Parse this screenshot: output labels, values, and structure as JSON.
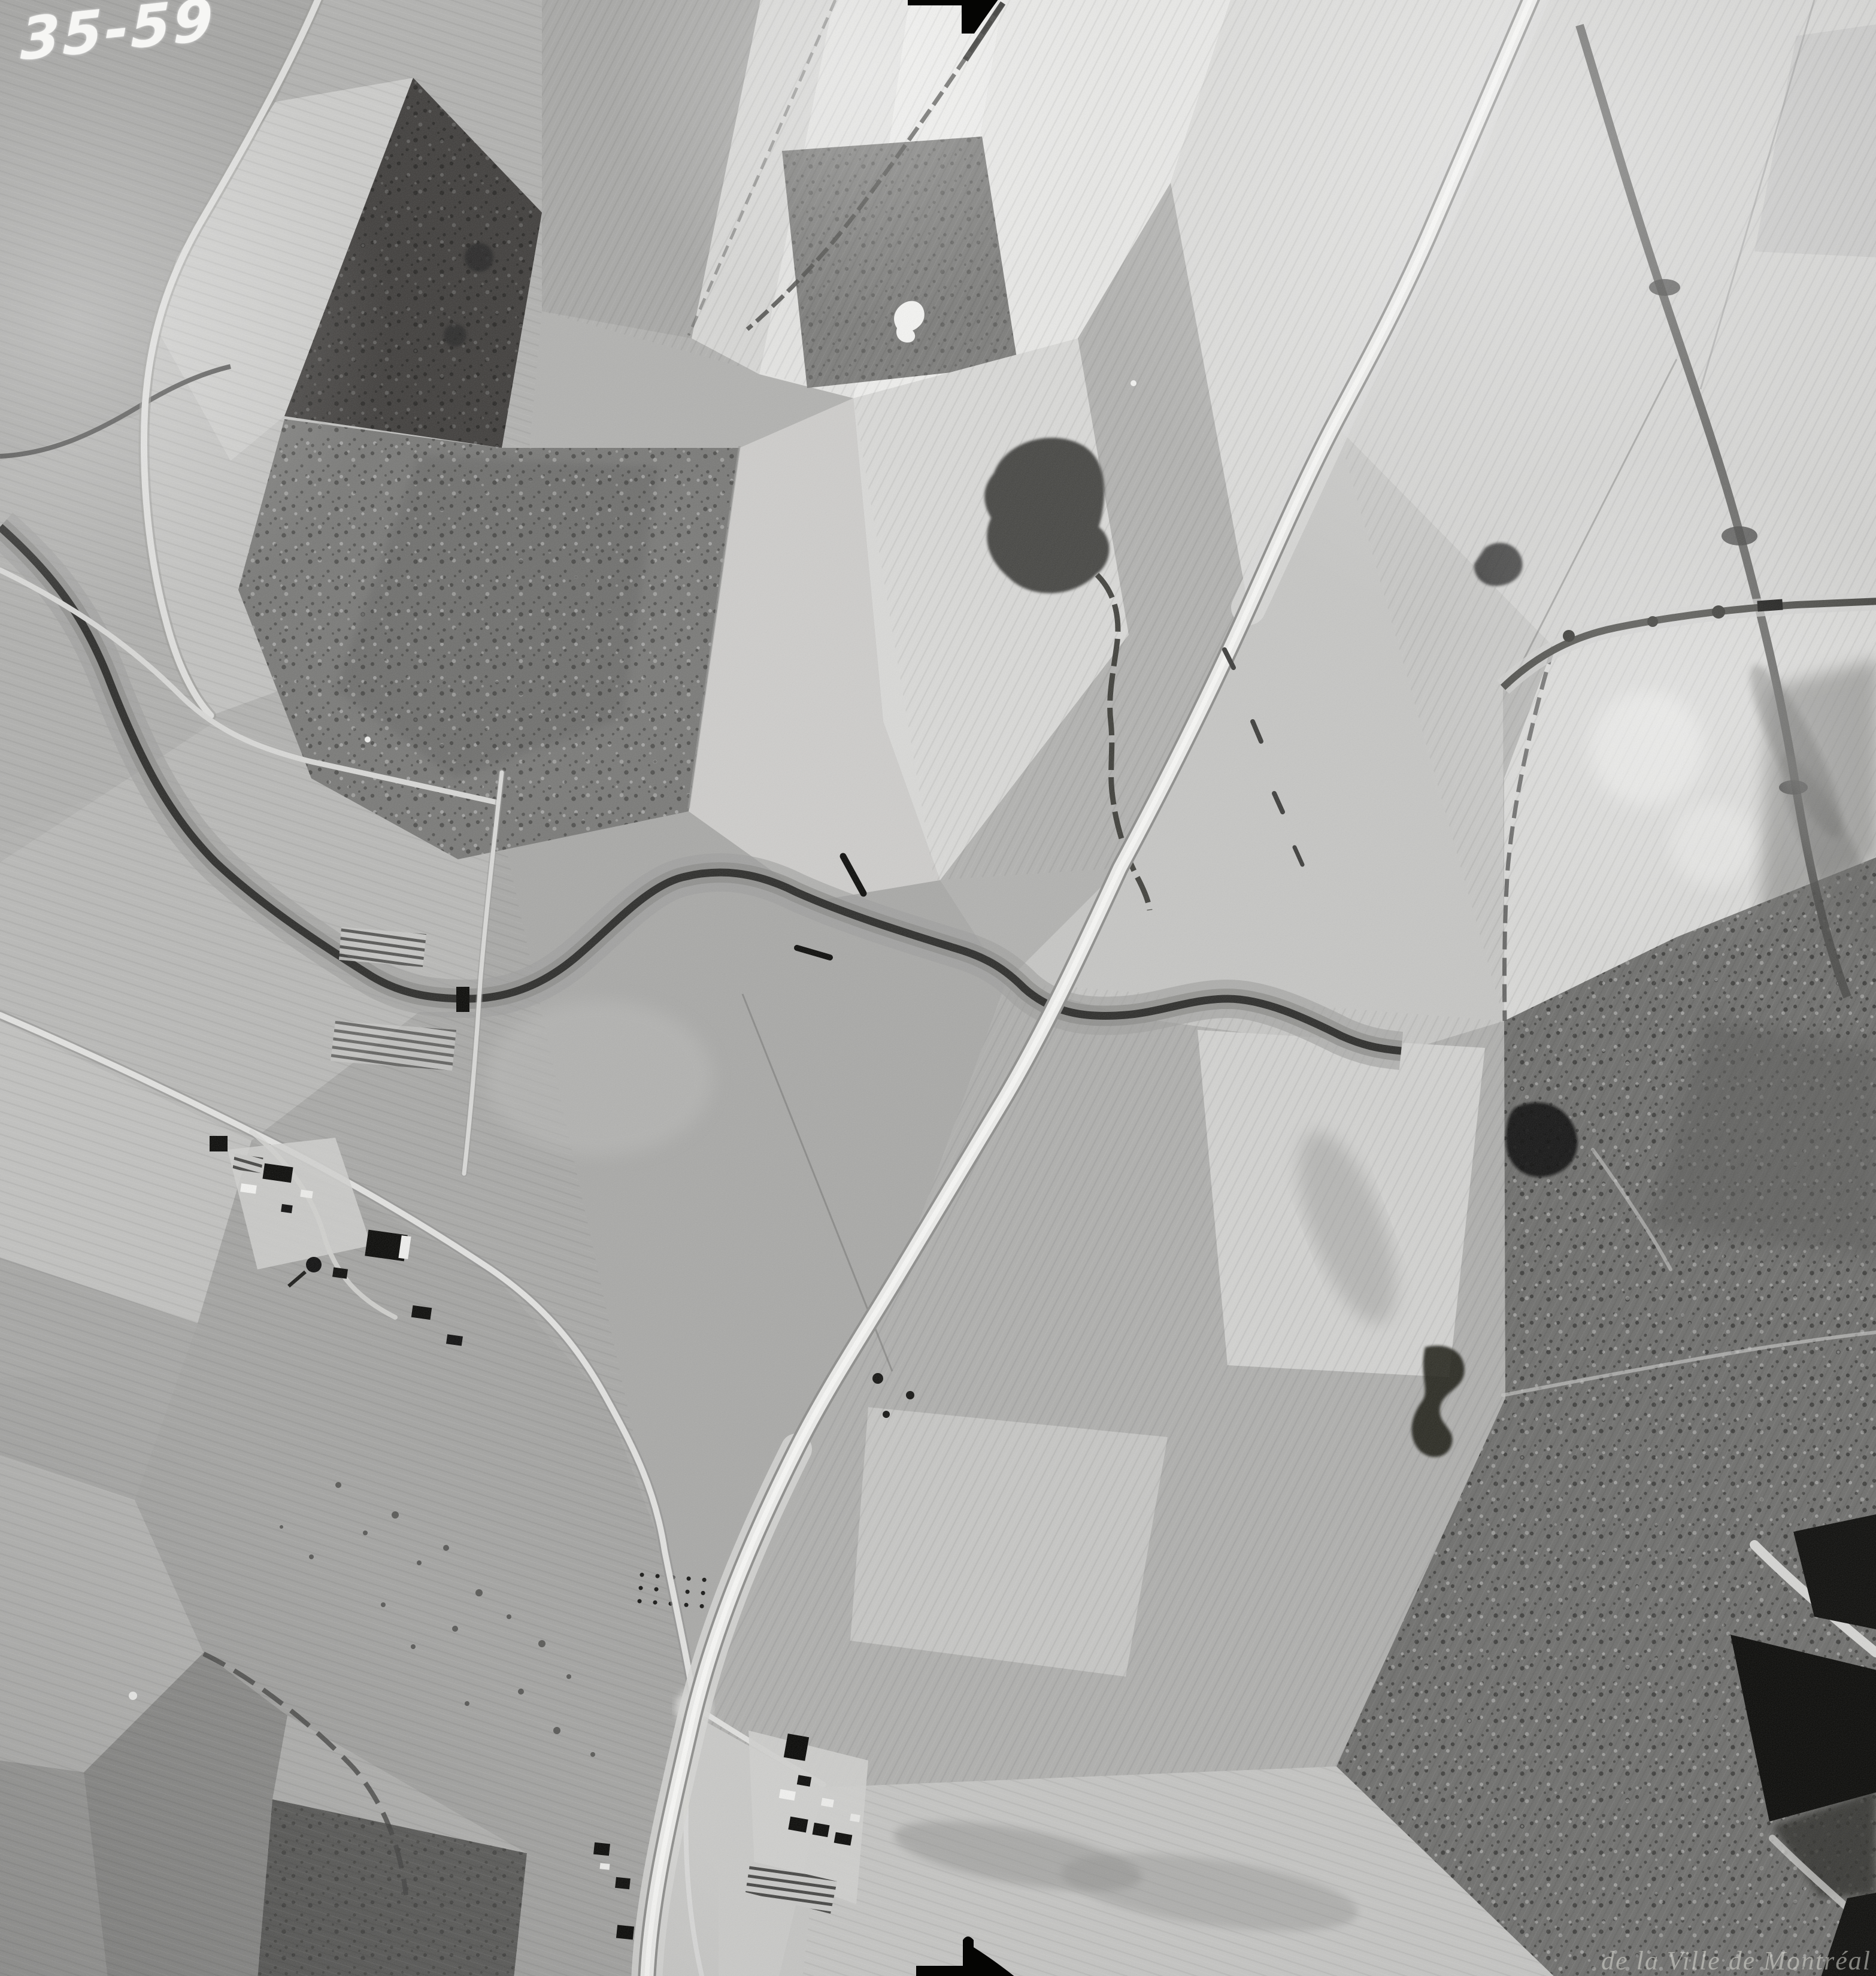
{
  "photo": {
    "id": "35-59",
    "watermark": "de la Ville de Montréal"
  },
  "fiducials": {
    "top": "right-pointing-arrow",
    "bottom": "right-pointing-arrow"
  },
  "palette": {
    "field_light": "#e4e4e2",
    "field_mid": "#aaaaa8",
    "field_dark": "#7c7c7a",
    "woodland": "#403e3c",
    "scrub": "#6f6f6d",
    "water": "#2d2d2b",
    "road": "#ededeb",
    "ink": "#050503",
    "label": "#f6f6f4"
  }
}
